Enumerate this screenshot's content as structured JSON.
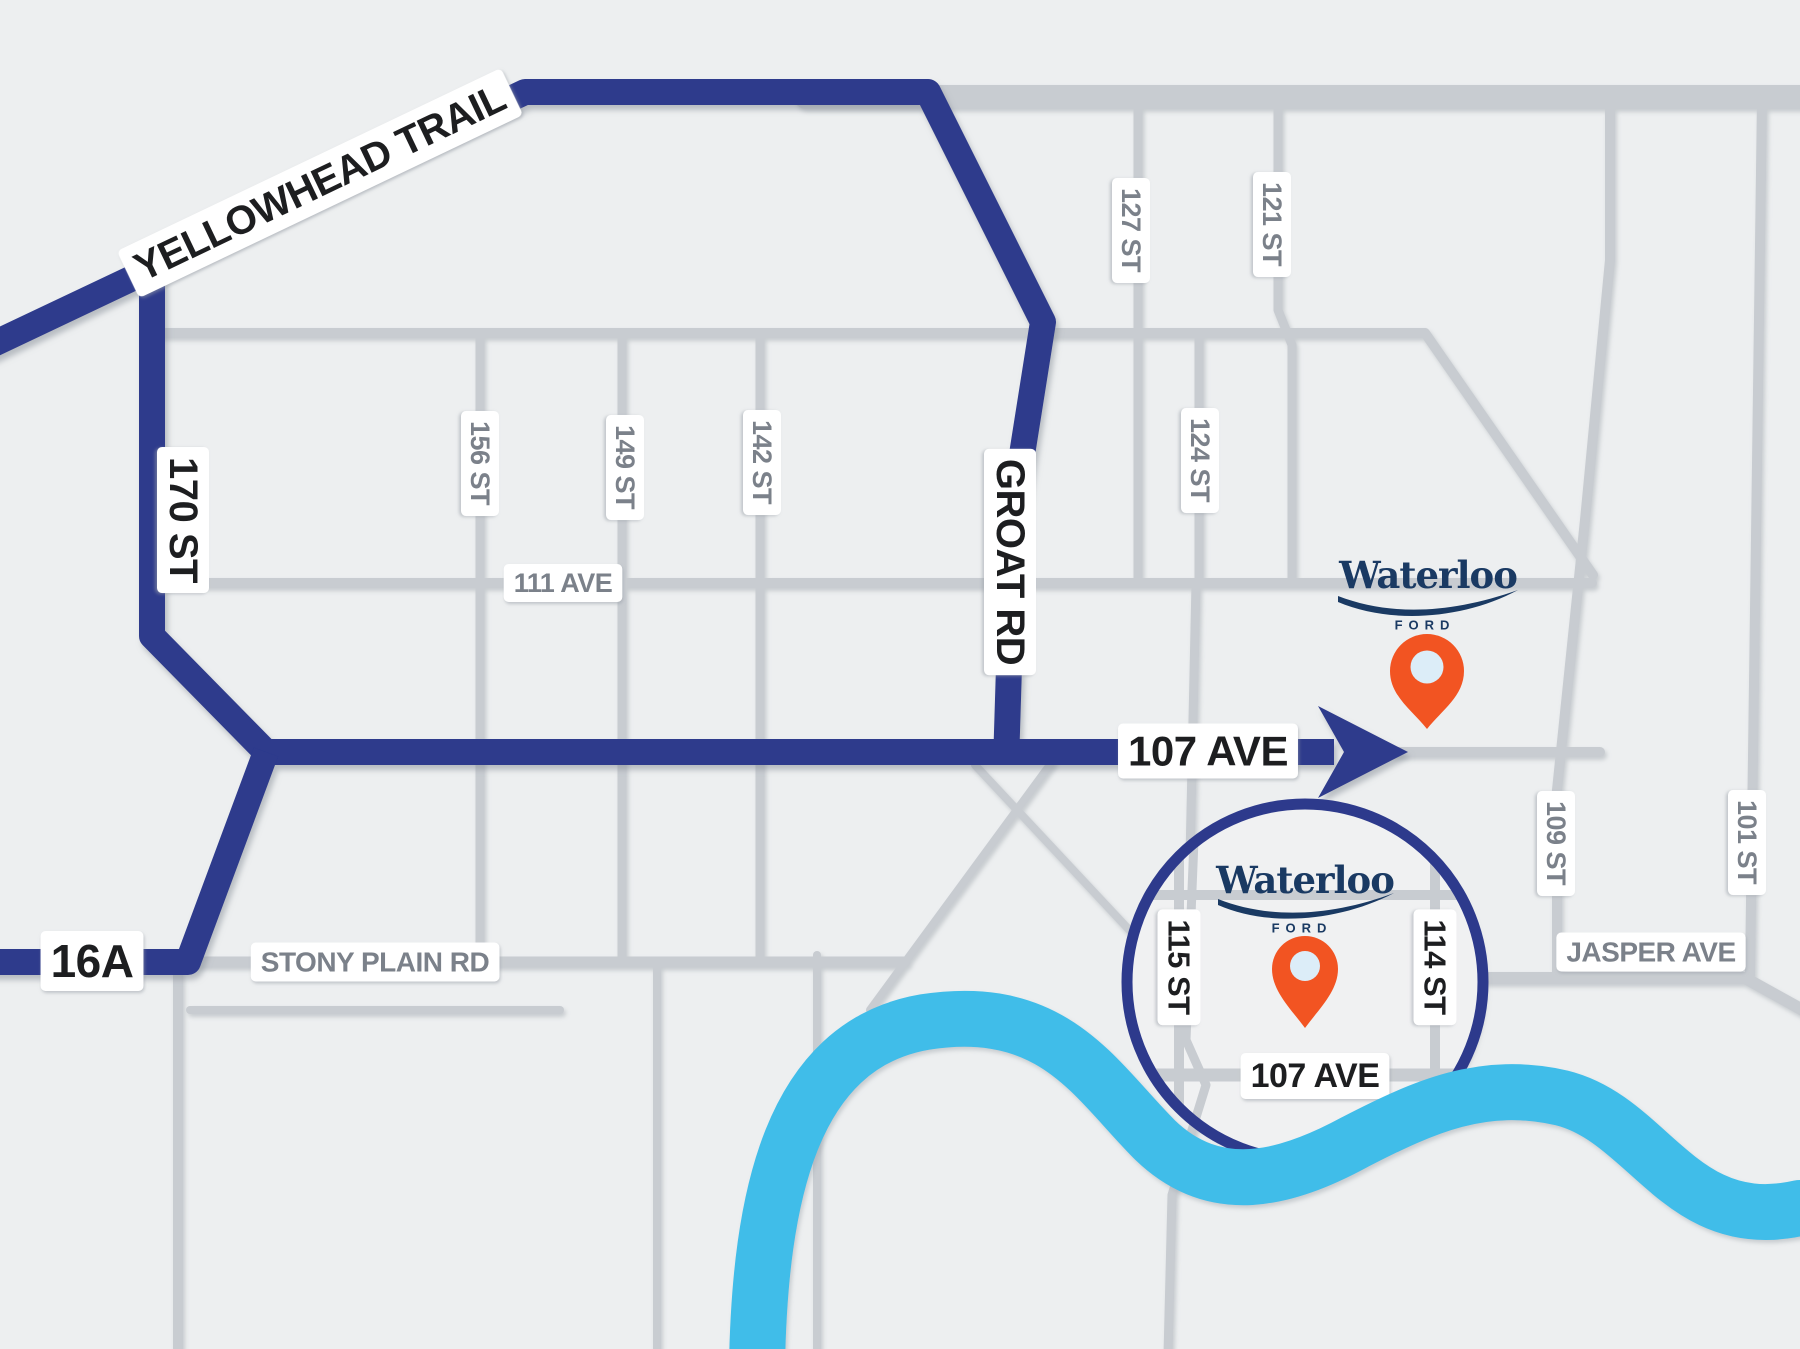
{
  "title": "Waterloo Ford location map",
  "colors": {
    "bg": "#edeff0",
    "road": "#c8ccd1",
    "road_minor": "#d2d5d9",
    "route_navy": "#2d3a8c",
    "river_blue": "#3fbde9",
    "label_black": "#1d1e20",
    "label_gray": "#7b818a",
    "logo_navy": "#1a3a63",
    "pin_orange": "#f25422",
    "pin_inner": "#dcedf8",
    "inset_fill": "#f0f1f2",
    "pill_white": "#ffffff"
  },
  "dealer": {
    "name": "Waterloo",
    "sub": "FORD"
  },
  "routes": {
    "width": 26,
    "paths": [
      {
        "id": "yellowhead-groat",
        "d": "M -15,348 L 525,92 L 928,92 L 1043,322 L 1014,505 L 1006,764"
      },
      {
        "id": "170st",
        "d": "M 152,262 L 152,636 L 266,752"
      },
      {
        "id": "107ave",
        "d": "M 252,752 L 1334,752"
      },
      {
        "id": "16a",
        "d": "M 266,752 L 188,962 L -15,962"
      }
    ],
    "arrow_points": "1318,706 1408,752 1318,798 1344,752"
  },
  "roads": [
    {
      "d": "M 806,97 L 1810,97",
      "w": 24
    },
    {
      "d": "M 160,333 L 1425,333 L 1593,575",
      "w": 10
    },
    {
      "d": "M 160,583 L 1592,583",
      "w": 10
    },
    {
      "d": "M 480,333 L 480,962",
      "w": 9
    },
    {
      "d": "M 622,333 L 622,962",
      "w": 9
    },
    {
      "d": "M 760,333 L 760,962",
      "w": 9
    },
    {
      "d": "M 1138,108 L 1138,583",
      "w": 9
    },
    {
      "d": "M 1278,108 L 1278,310 L 1292,345 L 1292,583",
      "w": 9
    },
    {
      "d": "M 1199,333 L 1199,583",
      "w": 9
    },
    {
      "d": "M 1196,583 L 1186,1040 L 1206,1085 L 1172,1195 L 1168,1355",
      "w": 9
    },
    {
      "d": "M 1610,99 L 1610,260 L 1585,520 L 1557,790 L 1557,978",
      "w": 10
    },
    {
      "d": "M 1762,99 L 1750,975",
      "w": 10
    },
    {
      "d": "M 1450,978 L 1745,978 L 1810,1014",
      "w": 12
    },
    {
      "d": "M 1395,752 L 1600,752",
      "w": 10
    },
    {
      "d": "M 190,962 L 905,962",
      "w": 11
    },
    {
      "d": "M 190,1010 L 560,1010",
      "w": 8
    },
    {
      "d": "M 178,962 L 178,1355",
      "w": 10
    },
    {
      "d": "M 657,962 L 657,1355",
      "w": 8
    },
    {
      "d": "M 817,955 L 817,1355",
      "w": 8
    },
    {
      "d": "M 975,765 L 1148,950",
      "w": 8
    },
    {
      "d": "M 1052,762 L 870,1010",
      "w": 8
    }
  ],
  "river": {
    "d": "M 757,1365 C 760,1200 790,1045 925,1022 C 1055,1002 1095,1080 1155,1140 C 1215,1198 1285,1180 1355,1142 C 1425,1106 1483,1080 1562,1098 C 1650,1120 1680,1235 1800,1208",
    "w": 56
  },
  "inset": {
    "cx": 1305,
    "cy": 982,
    "r": 178,
    "ring_w": 11,
    "roads": [
      {
        "d": "M 1179,798 L 1179,1165",
        "w": 10
      },
      {
        "d": "M 1435,798 L 1435,1165",
        "w": 10
      },
      {
        "d": "M 1128,895 L 1485,895",
        "w": 10
      },
      {
        "d": "M 1128,1075 L 1488,1075",
        "w": 13
      },
      {
        "d": "M 1196,790 L 1186,1040 L 1206,1085 L 1172,1195 L 1168,1280",
        "w": 9
      }
    ],
    "labels": [
      {
        "text": "115 ST",
        "x": 1179,
        "y": 967,
        "rot": 90,
        "size": 31
      },
      {
        "text": "114 ST",
        "x": 1435,
        "y": 967,
        "rot": 90,
        "size": 31
      },
      {
        "text": "107 AVE",
        "x": 1315,
        "y": 1076,
        "rot": 0,
        "size": 34
      }
    ]
  },
  "labels": {
    "route": [
      {
        "text": "YELLOWHEAD TRAIL",
        "x": 320,
        "y": 183,
        "rot": -25.5,
        "size": 40
      },
      {
        "text": "170 ST",
        "x": 183,
        "y": 520,
        "rot": 90,
        "size": 40
      },
      {
        "text": "GROAT RD",
        "x": 1010,
        "y": 562,
        "rot": 90,
        "size": 40
      },
      {
        "text": "107 AVE",
        "x": 1208,
        "y": 751,
        "rot": 0,
        "size": 42
      },
      {
        "text": "16A",
        "x": 92,
        "y": 961,
        "rot": 0,
        "size": 46
      }
    ],
    "street": [
      {
        "text": "156 ST",
        "x": 480,
        "y": 463,
        "rot": 90,
        "size": 27
      },
      {
        "text": "149 ST",
        "x": 625,
        "y": 467,
        "rot": 90,
        "size": 27
      },
      {
        "text": "142 ST",
        "x": 762,
        "y": 462,
        "rot": 90,
        "size": 27
      },
      {
        "text": "111 AVE",
        "x": 563,
        "y": 583,
        "rot": 0,
        "size": 27
      },
      {
        "text": "127 ST",
        "x": 1131,
        "y": 230,
        "rot": 90,
        "size": 27
      },
      {
        "text": "121 ST",
        "x": 1272,
        "y": 224,
        "rot": 90,
        "size": 27
      },
      {
        "text": "124 ST",
        "x": 1200,
        "y": 460,
        "rot": 90,
        "size": 27
      },
      {
        "text": "109 ST",
        "x": 1556,
        "y": 843,
        "rot": 90,
        "size": 27
      },
      {
        "text": "101 ST",
        "x": 1747,
        "y": 842,
        "rot": 90,
        "size": 27
      },
      {
        "text": "JASPER AVE",
        "x": 1651,
        "y": 952,
        "rot": 0,
        "size": 28
      },
      {
        "text": "STONY PLAIN RD",
        "x": 375,
        "y": 962,
        "rot": 0,
        "size": 28
      }
    ]
  }
}
